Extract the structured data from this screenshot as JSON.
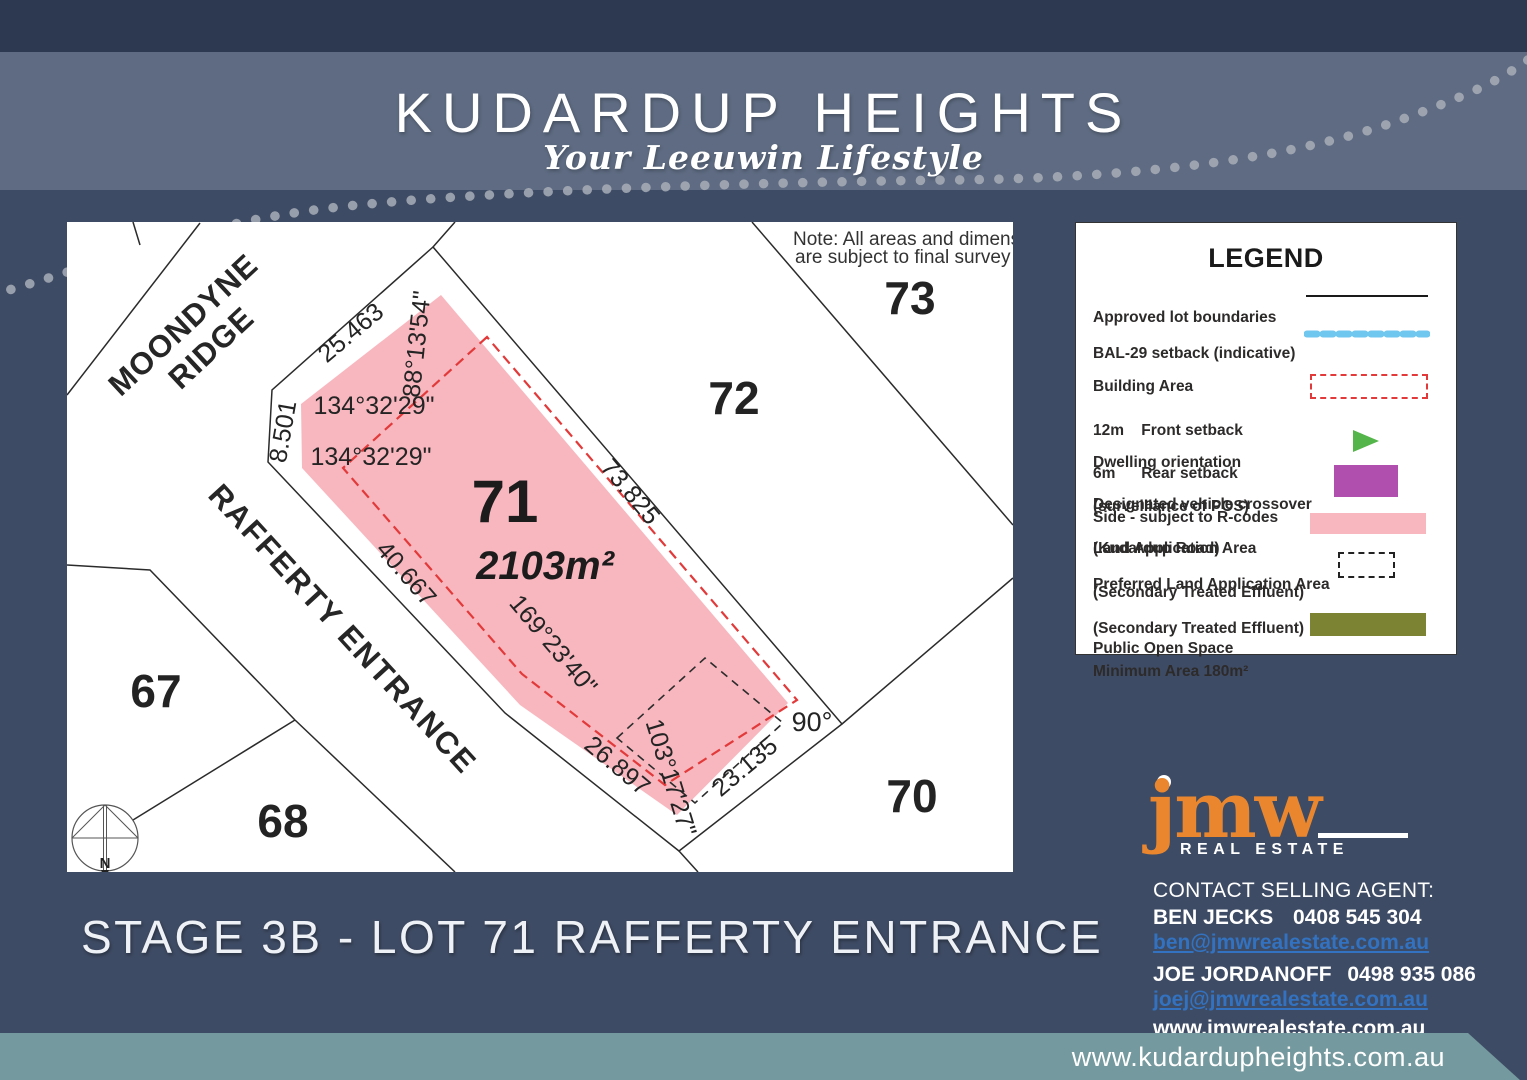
{
  "header": {
    "title": "KUDARDUP HEIGHTS",
    "subtitle": "Your Leeuwin Lifestyle"
  },
  "plan": {
    "note_line1": "Note: All areas and dimensions",
    "note_line2": "are subject to final survey",
    "street_moondyne_line1": "MOONDYNE",
    "street_moondyne_line2": "RIDGE",
    "street_rafferty": "RAFFERTY ENTRANCE",
    "lot_number": "71",
    "lot_area": "2103m²",
    "neighbor_67": "67",
    "neighbor_68": "68",
    "neighbor_70": "70",
    "neighbor_72": "72",
    "neighbor_73": "73",
    "north_label": "N",
    "dims": {
      "top_boundary": "25.463",
      "angle_top": "88°13'54\"",
      "angle_134_upper": "134°32'29\"",
      "angle_134_lower": "134°32'29\"",
      "left_boundary": "8.501",
      "road_boundary_upper": "40.667",
      "angle_169": "169°23'40\"",
      "road_boundary_lower": "26.897",
      "angle_103": "103°17'27\"",
      "bottom_right_boundary": "23.135",
      "angle_90": "90°",
      "right_boundary": "73.825"
    }
  },
  "legend": {
    "title": "LEGEND",
    "rows": [
      {
        "symbol": "solid-line",
        "lines": [
          "Approved lot boundaries"
        ]
      },
      {
        "symbol": "blue-dashed-line",
        "lines": [
          "BAL-29 setback (indicative)"
        ]
      },
      {
        "symbol": "red-dashed-rect",
        "lines": [
          "Building Area",
          "12m    Front setback",
          "6m      Rear setback",
          "Side - subject to R-codes"
        ]
      },
      {
        "symbol": "green-triangle",
        "lines": [
          "Dwelling orientation",
          "(surveillance of POS)"
        ]
      },
      {
        "symbol": "purple-rect",
        "lines": [
          "Designated vehicle crossover",
          "(Kudardup Road)"
        ]
      },
      {
        "symbol": "pink-rect",
        "lines": [
          "Land Application Area",
          "(Secondary Treated Effluent)"
        ]
      },
      {
        "symbol": "black-dashed-rect",
        "lines": [
          "Preferred Land Application Area",
          "(Secondary Treated Effluent)",
          "Minimum Area 180m²"
        ]
      },
      {
        "symbol": "olive-rect",
        "lines": [
          "Public Open Space"
        ]
      }
    ]
  },
  "stage_title": "STAGE 3B - LOT 71 RAFFERTY ENTRANCE",
  "agency": {
    "logo_text": "jmw",
    "logo_subtext": "REAL ESTATE",
    "contact_heading": "CONTACT SELLING AGENT:",
    "agent1_name": "BEN JECKS",
    "agent1_phone": "0408 545 304",
    "agent1_email": "ben@jmwrealestate.com.au",
    "agent2_name": "JOE JORDANOFF",
    "agent2_phone": "0498 935 086",
    "agent2_email": "joej@jmwrealestate.com.au",
    "website": "www.jmwrealestate.com.au"
  },
  "footer": {
    "website": "www.kudardupheights.com.au"
  },
  "colors": {
    "navy_background": "#3e4b64",
    "navy_dark_band": "#2d3950",
    "title_band": "#5e6b82",
    "teal_footer": "#74999e",
    "lot_pink": "#f8b7bf",
    "building_red": "#e23a3a",
    "bal29_blue": "#6fc6ef",
    "dwelling_green": "#54b54a",
    "crossover_purple": "#b14fae",
    "pos_olive": "#7c8433",
    "jmw_orange": "#ea872e",
    "link_blue": "#3272c0"
  }
}
